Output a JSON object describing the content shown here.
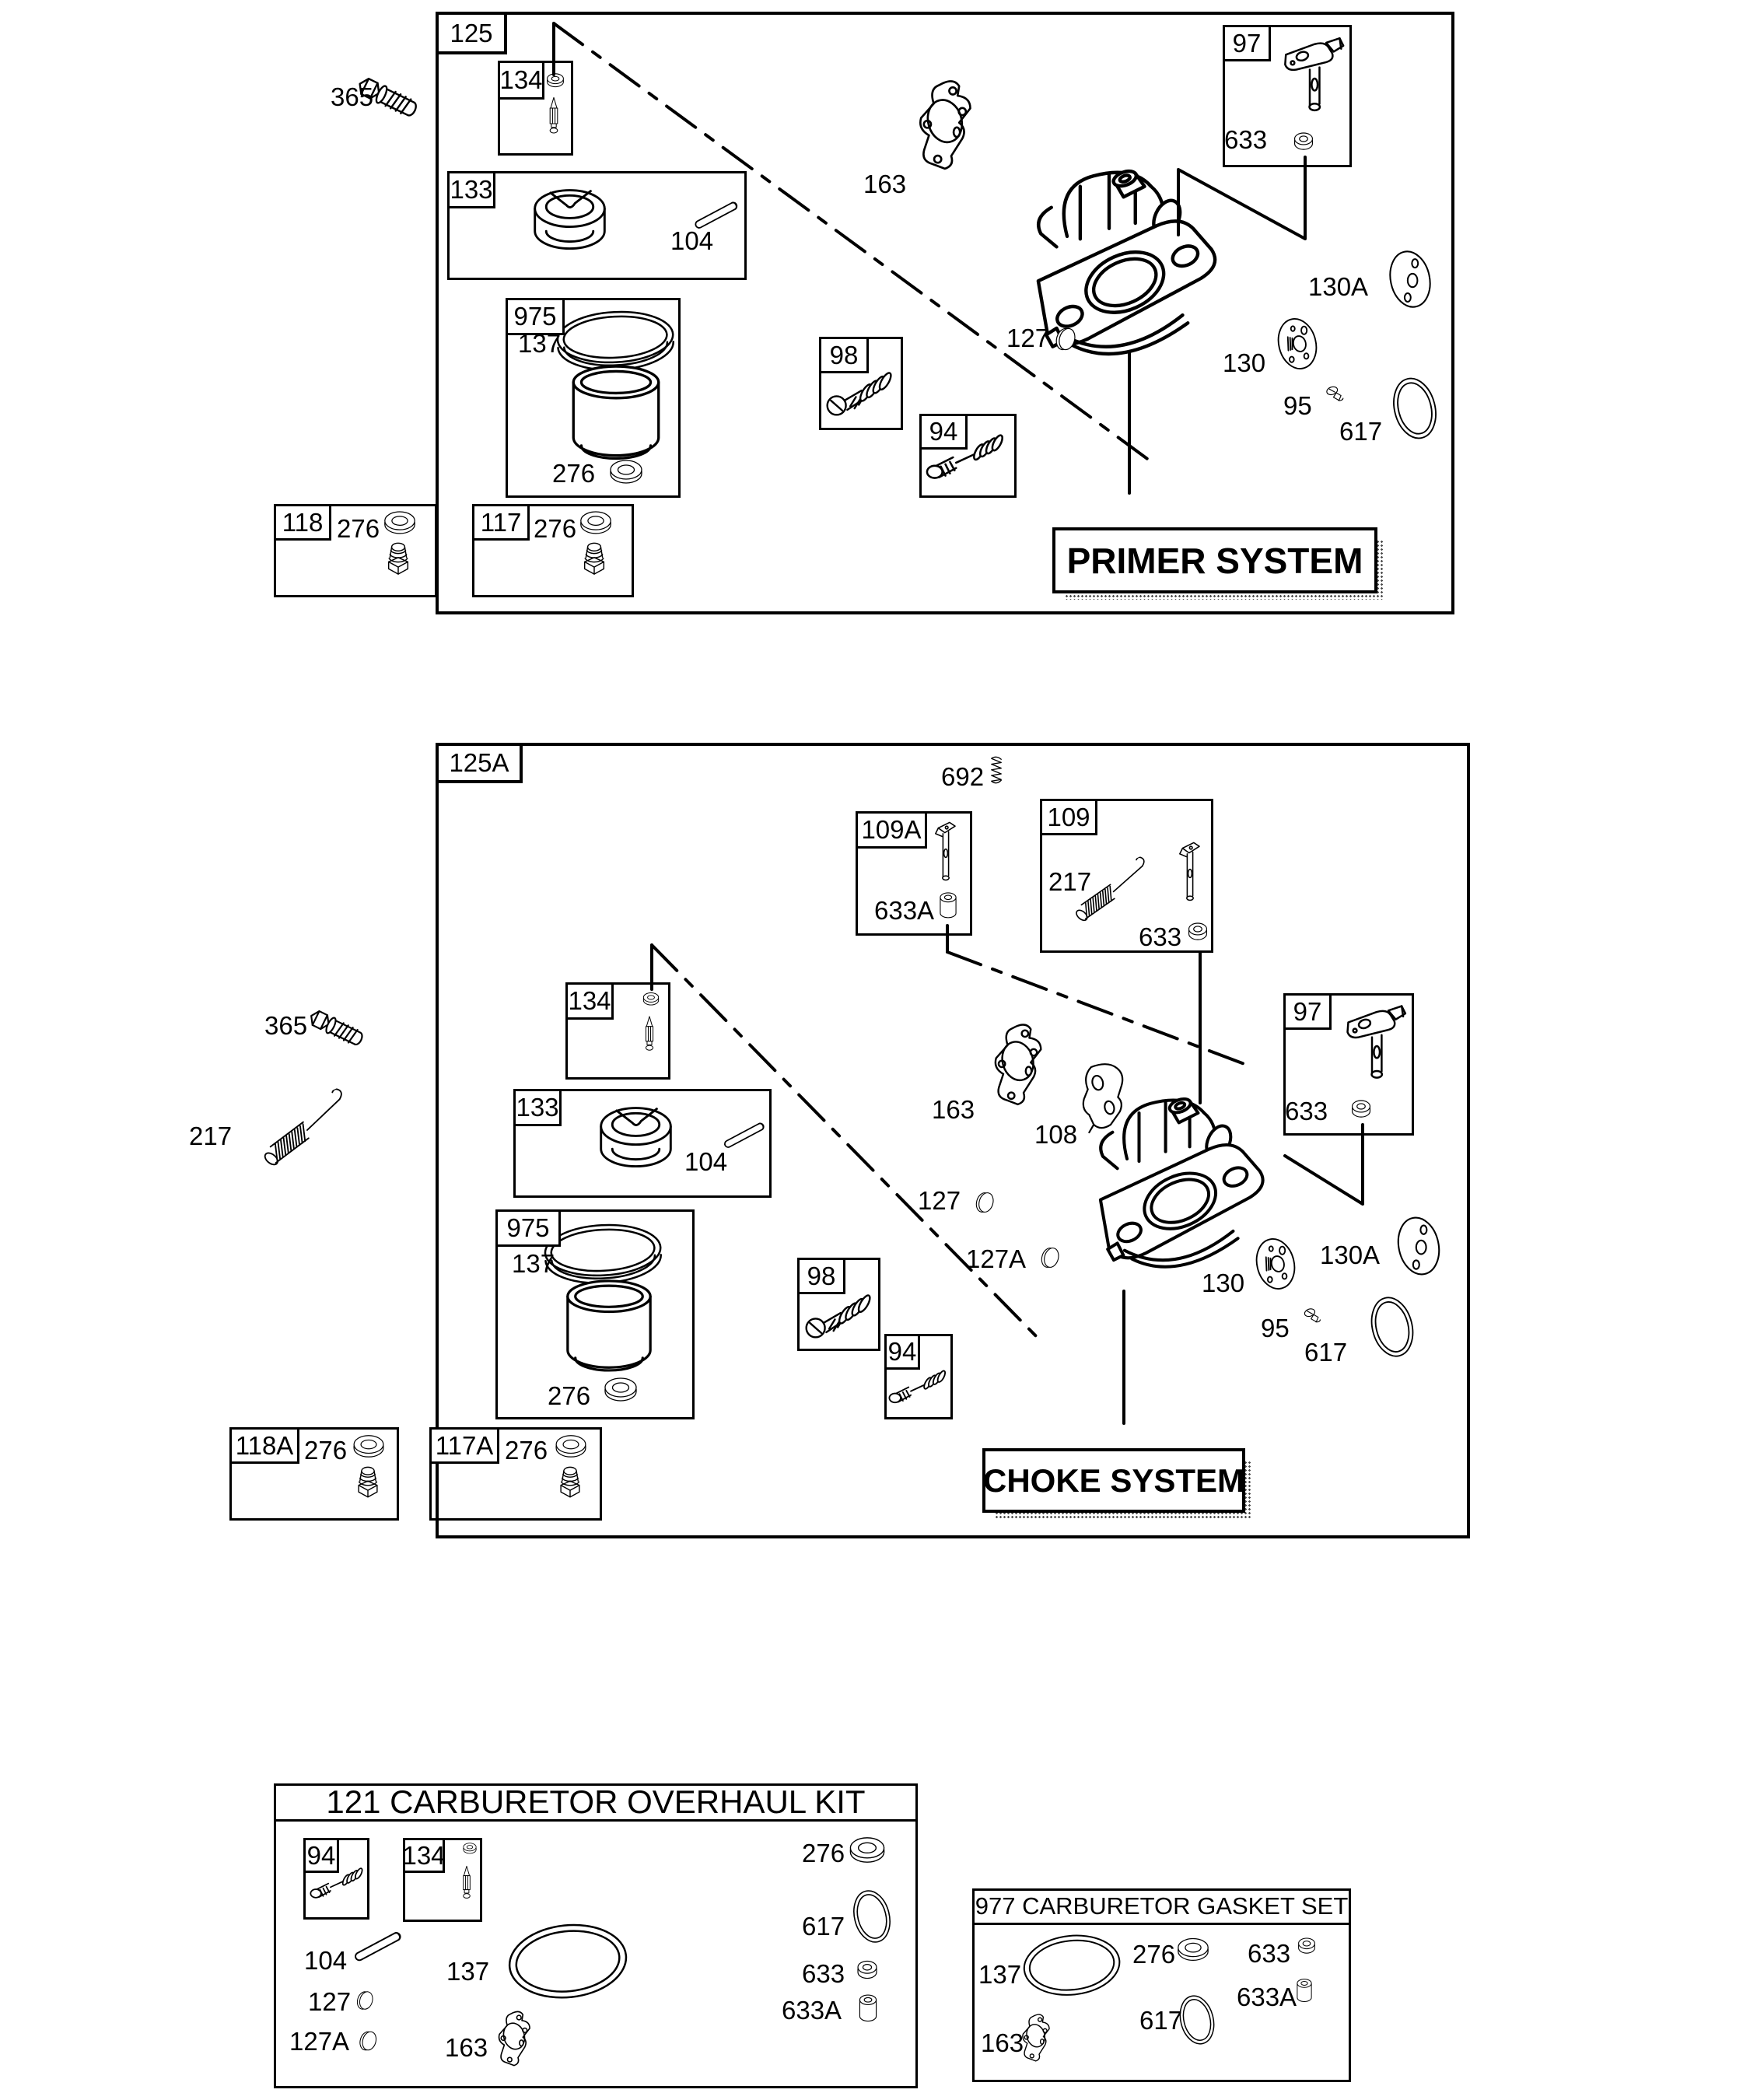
{
  "primer": {
    "id": "125",
    "title": "PRIMER SYSTEM",
    "bolt": "365",
    "needle_kit": "134",
    "float_kit": "133",
    "float_pin": "104",
    "bowl_kit": "975",
    "bowl_gasket": "137",
    "bowl_washer": "276",
    "screw_kit": "98",
    "needle_valve_kit": "94",
    "carb_gasket": "163",
    "welch_plug": "127",
    "primer_kit": "97",
    "seal": "633",
    "plate": "130",
    "plate_a": "130A",
    "plug_screw": "95",
    "oring": "617",
    "drain_118": "118",
    "drain_118_washer": "276",
    "drain_117": "117",
    "drain_117_washer": "276"
  },
  "choke": {
    "id": "125A",
    "title": "CHOKE SYSTEM",
    "spring_692": "692",
    "shaft_kit_a": "109A",
    "bushing_a": "633A",
    "shaft_kit": "109",
    "shaft_spring": "217",
    "shaft_seal": "633",
    "bolt": "365",
    "link_spring": "217",
    "needle_kit": "134",
    "float_kit": "133",
    "float_pin": "104",
    "bowl_kit": "975",
    "bowl_gasket": "137",
    "bowl_washer": "276",
    "screw_kit": "98",
    "needle_valve_kit": "94",
    "carb_gasket": "163",
    "choke_plate": "108",
    "welch_plug": "127",
    "welch_plug_a": "127A",
    "primer_kit": "97",
    "seal": "633",
    "plate": "130",
    "plate_a": "130A",
    "plug_screw": "95",
    "oring": "617",
    "drain_118a": "118A",
    "drain_118a_washer": "276",
    "drain_117a": "117A",
    "drain_117a_washer": "276"
  },
  "kit": {
    "title": "121 CARBURETOR OVERHAUL KIT",
    "needle_valve_kit": "94",
    "needle_kit": "134",
    "float_pin": "104",
    "bowl_gasket": "137",
    "welch_plug": "127",
    "welch_plug_a": "127A",
    "carb_gasket": "163",
    "bowl_washer": "276",
    "oring": "617",
    "seal": "633",
    "bushing": "633A"
  },
  "gasket_set": {
    "title": "977 CARBURETOR GASKET SET",
    "bowl_gasket": "137",
    "carb_gasket": "163",
    "bowl_washer": "276",
    "oring": "617",
    "seal": "633",
    "bushing": "633A"
  }
}
